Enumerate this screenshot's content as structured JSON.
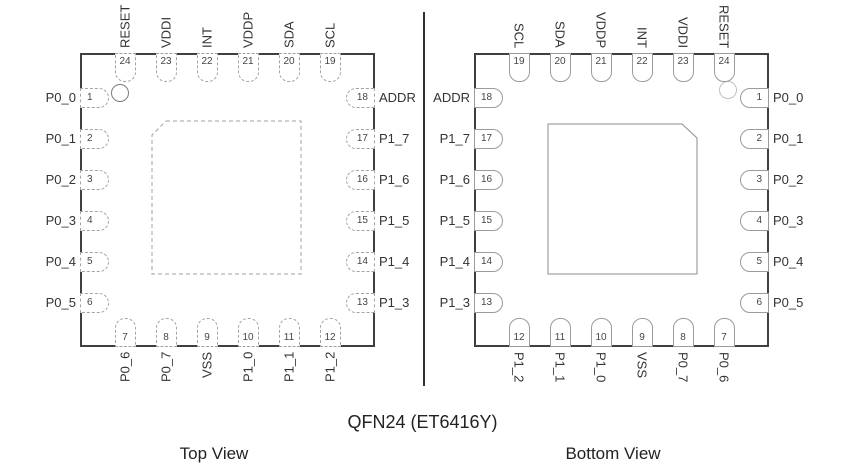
{
  "title": "QFN24 (ET6416Y)",
  "colors": {
    "outline": "#404040",
    "pin_outline_dashed": "#a3a3a3",
    "pin_outline_solid": "#9b9b9b",
    "text": "#333333"
  },
  "views": [
    {
      "caption": "Top View",
      "pins": {
        "top": [
          {
            "num": "24",
            "label": "RESET"
          },
          {
            "num": "23",
            "label": "VDDI"
          },
          {
            "num": "22",
            "label": "INT"
          },
          {
            "num": "21",
            "label": "VDDP"
          },
          {
            "num": "20",
            "label": "SDA"
          },
          {
            "num": "19",
            "label": "SCL"
          }
        ],
        "left": [
          {
            "num": "1",
            "label": "P0_0"
          },
          {
            "num": "2",
            "label": "P0_1"
          },
          {
            "num": "3",
            "label": "P0_2"
          },
          {
            "num": "4",
            "label": "P0_3"
          },
          {
            "num": "5",
            "label": "P0_4"
          },
          {
            "num": "6",
            "label": "P0_5"
          }
        ],
        "right": [
          {
            "num": "18",
            "label": "ADDR"
          },
          {
            "num": "17",
            "label": "P1_7"
          },
          {
            "num": "16",
            "label": "P1_6"
          },
          {
            "num": "15",
            "label": "P1_5"
          },
          {
            "num": "14",
            "label": "P1_4"
          },
          {
            "num": "13",
            "label": "P1_3"
          }
        ],
        "bottom": [
          {
            "num": "7",
            "label": "P0_6"
          },
          {
            "num": "8",
            "label": "P0_7"
          },
          {
            "num": "9",
            "label": "VSS"
          },
          {
            "num": "10",
            "label": "P1_0"
          },
          {
            "num": "11",
            "label": "P1_1"
          },
          {
            "num": "12",
            "label": "P1_2"
          }
        ]
      }
    },
    {
      "caption": "Bottom View",
      "pins": {
        "top": [
          {
            "num": "19",
            "label": "SCL"
          },
          {
            "num": "20",
            "label": "SDA"
          },
          {
            "num": "21",
            "label": "VDDP"
          },
          {
            "num": "22",
            "label": "INT"
          },
          {
            "num": "23",
            "label": "VDDI"
          },
          {
            "num": "24",
            "label": "RESET"
          }
        ],
        "left": [
          {
            "num": "18",
            "label": "ADDR"
          },
          {
            "num": "17",
            "label": "P1_7"
          },
          {
            "num": "16",
            "label": "P1_6"
          },
          {
            "num": "15",
            "label": "P1_5"
          },
          {
            "num": "14",
            "label": "P1_4"
          },
          {
            "num": "13",
            "label": "P1_3"
          }
        ],
        "right": [
          {
            "num": "1",
            "label": "P0_0"
          },
          {
            "num": "2",
            "label": "P0_1"
          },
          {
            "num": "3",
            "label": "P0_2"
          },
          {
            "num": "4",
            "label": "P0_3"
          },
          {
            "num": "5",
            "label": "P0_4"
          },
          {
            "num": "6",
            "label": "P0_5"
          }
        ],
        "bottom": [
          {
            "num": "12",
            "label": "P1_2"
          },
          {
            "num": "11",
            "label": "P1_1"
          },
          {
            "num": "10",
            "label": "P1_0"
          },
          {
            "num": "9",
            "label": "VSS"
          },
          {
            "num": "8",
            "label": "P0_7"
          },
          {
            "num": "7",
            "label": "P0_6"
          }
        ]
      }
    }
  ]
}
